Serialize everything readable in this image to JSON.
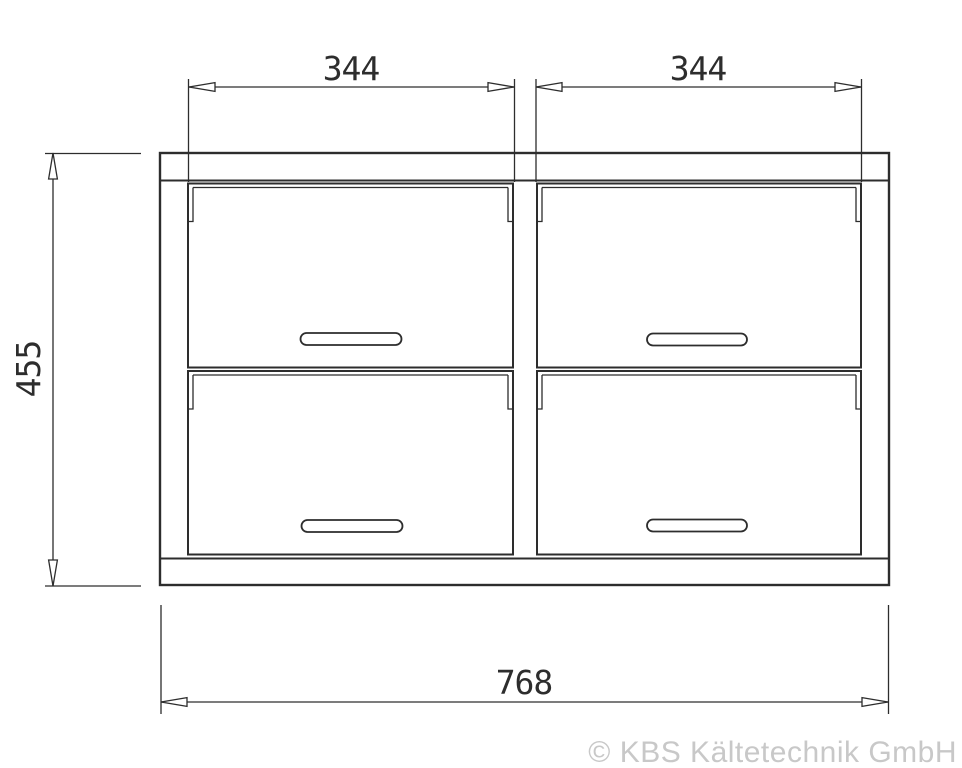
{
  "diagram": {
    "description": "Technical front-view drawing of a cabinet with four drawers in a 2x2 grid, with dimension lines",
    "dimensions": {
      "top_left_width": "344",
      "top_right_width": "344",
      "left_height": "455",
      "bottom_total_width": "768"
    },
    "copyright": "© KBS Kältetechnik GmbH",
    "colors": {
      "line": "#2d2d2d",
      "copyright_text": "#c8c8c8",
      "background": "#ffffff"
    }
  }
}
